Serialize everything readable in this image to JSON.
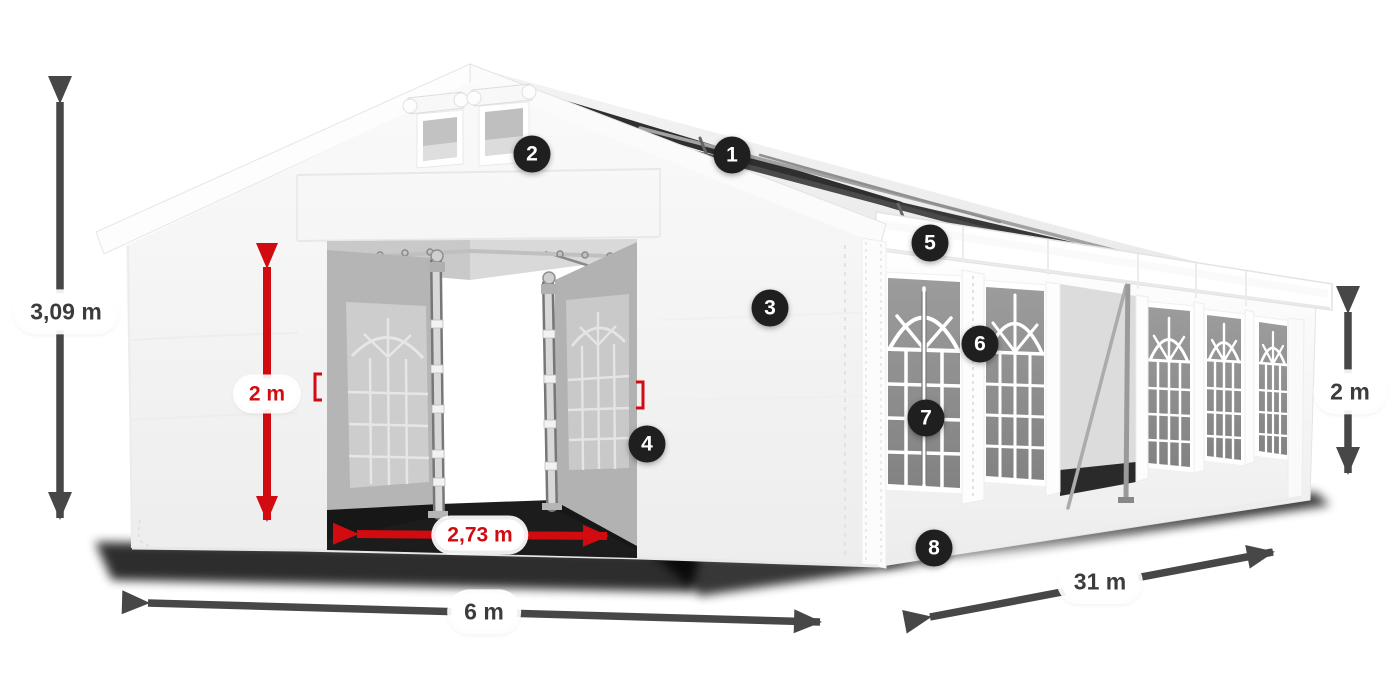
{
  "badges": [
    {
      "number": "1"
    },
    {
      "number": "2"
    },
    {
      "number": "3"
    },
    {
      "number": "4"
    },
    {
      "number": "5"
    },
    {
      "number": "6"
    },
    {
      "number": "7"
    },
    {
      "number": "8"
    }
  ],
  "dimension_labels": [
    {
      "id": "overall-height",
      "text": "3,09 m",
      "color": "dark"
    },
    {
      "id": "door-height",
      "text": "2 m",
      "color": "red"
    },
    {
      "id": "door-width",
      "text": "2,73 m",
      "color": "red"
    },
    {
      "id": "front-width",
      "text": "6 m",
      "color": "dark"
    },
    {
      "id": "side-length",
      "text": "31 m",
      "color": "dark"
    },
    {
      "id": "side-wall-height",
      "text": "2 m",
      "color": "dark"
    }
  ],
  "colors": {
    "accent-red": "#d20b10",
    "arrow-dark": "#474747",
    "badge-bg": "#1f1f1f",
    "label-text": "#3c3c3c",
    "pill-bg": "#ffffff"
  }
}
